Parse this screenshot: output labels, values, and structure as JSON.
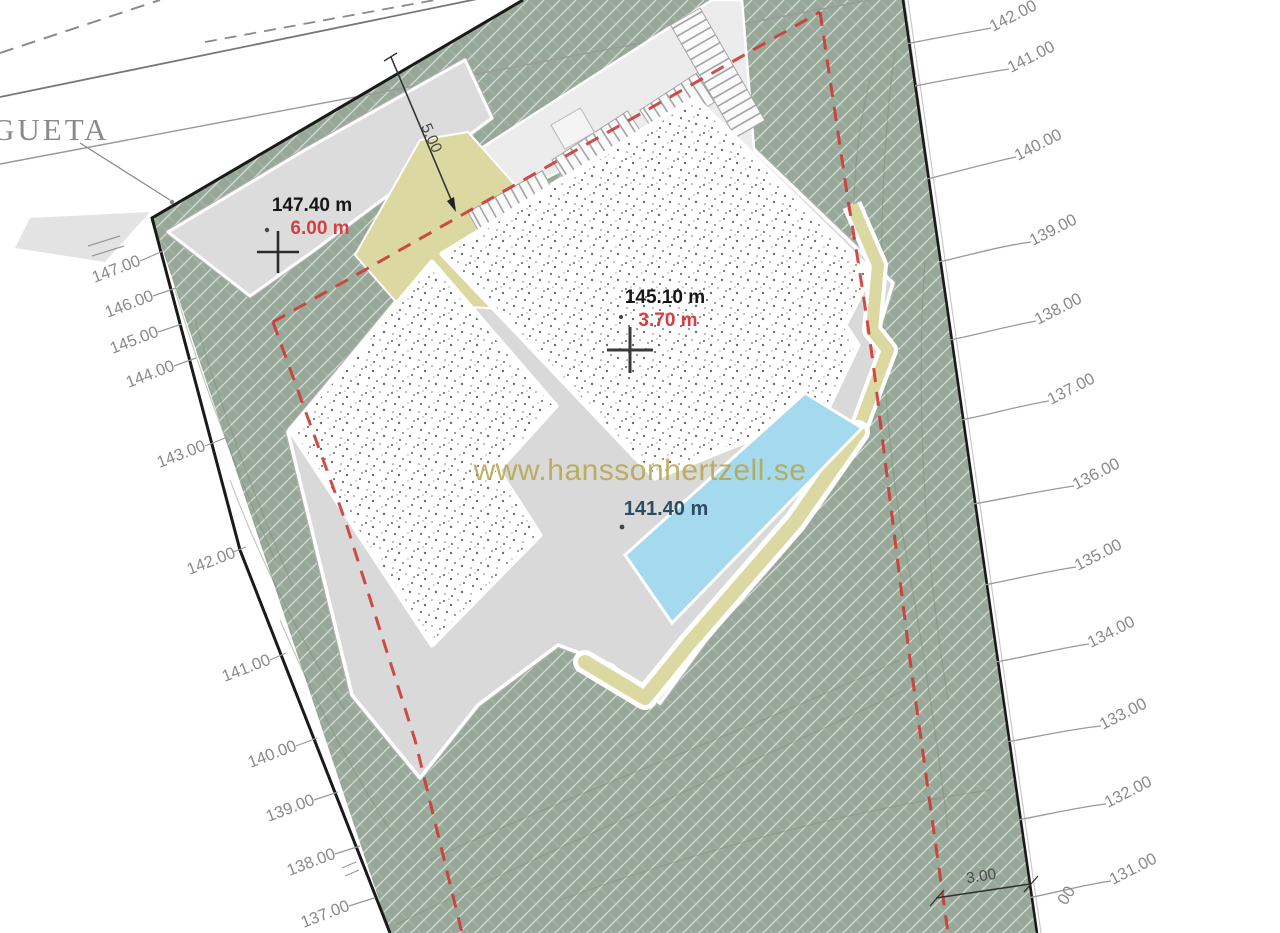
{
  "watermark": {
    "text": "www.hanssonhertzell.se",
    "color": "#b5a54d"
  },
  "street": {
    "name_partial": "GUETA"
  },
  "levels": {
    "upper_terrace": {
      "elevation": "147.40 m",
      "height": "6.00 m"
    },
    "main_terrace": {
      "elevation": "145.10 m",
      "height": "3.70 m"
    },
    "pool_terrace": {
      "elevation": "141.40 m"
    }
  },
  "dimensions": {
    "setback_top": "5.00",
    "setback_bottom": "3.00"
  },
  "contours_left": [
    "147.00",
    "146.00",
    "145.00",
    "144.00",
    "143.00",
    "142.00",
    "141.00",
    "140.00",
    "139.00",
    "138.00",
    "137.00"
  ],
  "contours_right": [
    "142.00",
    "141.00",
    "140.00",
    "139.00",
    "138.00",
    "137.00",
    "136.00",
    "135.00",
    "134.00",
    "133.00",
    "132.00",
    "131.00",
    "00"
  ],
  "colors": {
    "terrain_green": "#97a899",
    "pool_blue": "#a5daee",
    "sand_path": "#dbd8a2",
    "setback_red": "#cc3a35",
    "annotation_red": "#d63f3f",
    "pool_level_blue": "#2b4d63"
  }
}
